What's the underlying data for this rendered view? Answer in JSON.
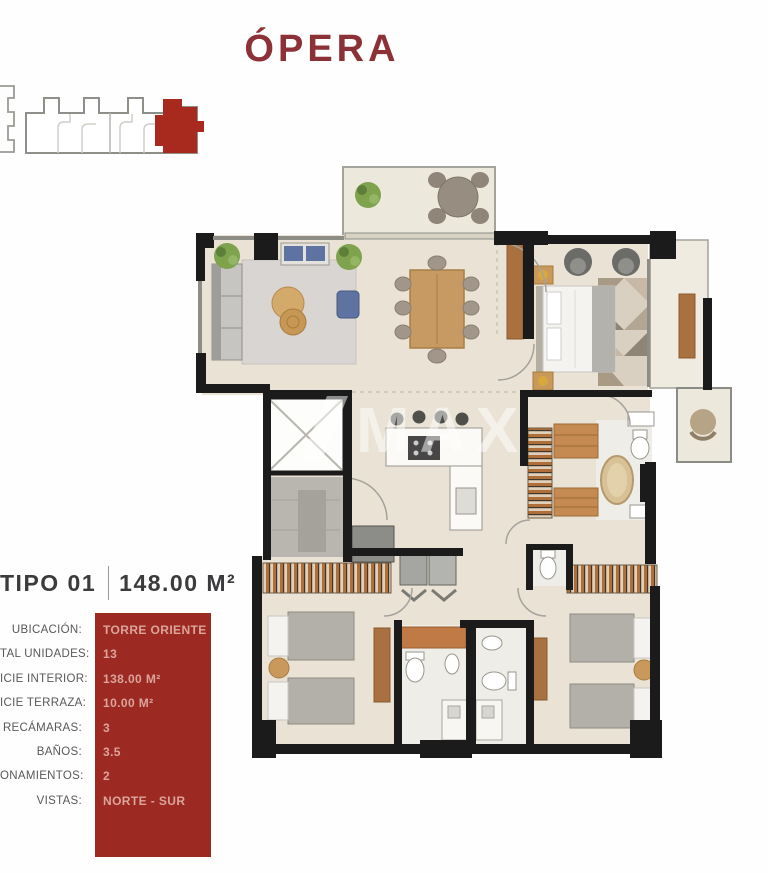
{
  "title": "ÓPERA",
  "watermark": {
    "text": "MAX"
  },
  "unit_header": {
    "type": "TIPO 01",
    "area": "148.00 M²"
  },
  "specs": {
    "rows": [
      {
        "label": "UBICACIÓN:",
        "value": "TORRE ORIENTE"
      },
      {
        "label": "TAL UNIDADES:",
        "value": "13"
      },
      {
        "label": "ICIE INTERIOR:",
        "value": "138.00 M²"
      },
      {
        "label": "ICIE TERRAZA:",
        "value": "10.00 M²"
      },
      {
        "label": "RECÁMARAS:",
        "value": "3"
      },
      {
        "label": "BAÑOS:",
        "value": "3.5"
      },
      {
        "label": "ONAMIENTOS:",
        "value": "2"
      },
      {
        "label": "VISTAS:",
        "value": "NORTE - SUR"
      }
    ]
  },
  "colors": {
    "brand_red": "#9C2A22",
    "highlight_unit_red": "#A82A1F",
    "title_maroon": "#8C3136",
    "spec_value_pink": "#DBA49C",
    "label_gray": "#58585A",
    "wall_black": "#1B1B1B",
    "floor_beige": "#E9E2D5"
  }
}
